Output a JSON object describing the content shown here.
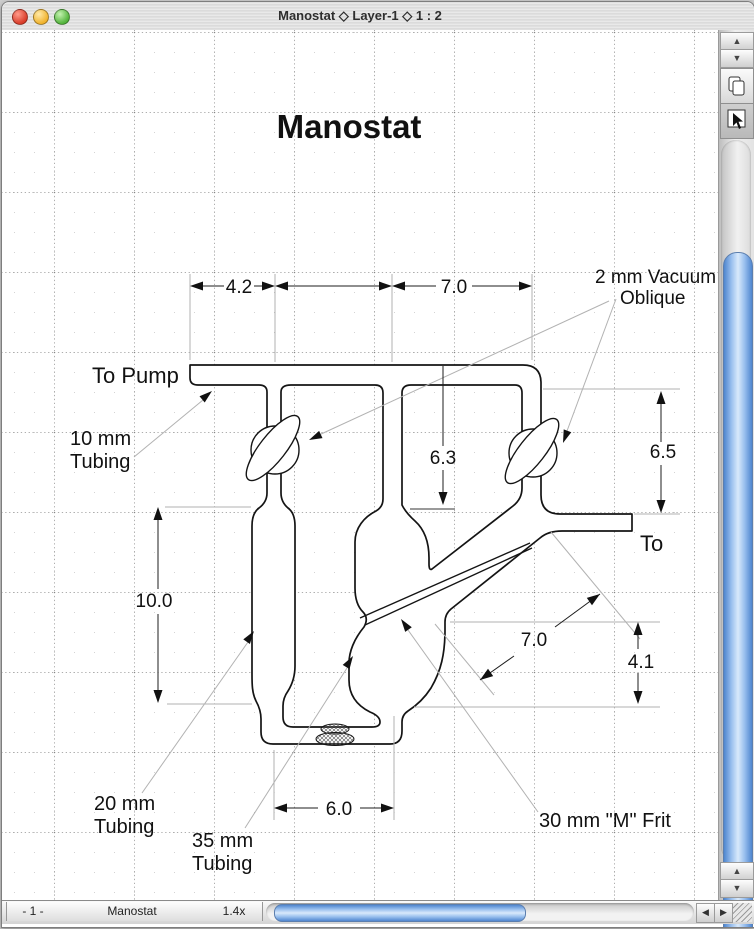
{
  "window": {
    "title": "Manostat ◇ Layer-1 ◇ 1 : 2"
  },
  "drawing": {
    "title": "Manostat",
    "labels": {
      "to_pump": "To Pump",
      "to": "To",
      "tubing10": [
        "10 mm",
        "Tubing"
      ],
      "tubing20": [
        "20 mm",
        "Tubing"
      ],
      "tubing35": [
        "35 mm",
        "Tubing"
      ],
      "frit": "30 mm \"M\" Frit",
      "oblique": [
        "2 mm Vacuum",
        "Oblique"
      ]
    },
    "dims": {
      "top_left": "4.2",
      "top_right": "7.0",
      "inner_depth": "6.3",
      "right_height": "6.5",
      "left_height": "10.0",
      "bottom_width": "6.0",
      "diagonal": "7.0",
      "outlet_height": "4.1"
    }
  },
  "statusbar": {
    "page": "- 1 -",
    "tab": "Manostat",
    "zoom": "1.4x"
  },
  "colors": {
    "scrollbar_blue": "#6ea3e8",
    "close": "#d93d2a",
    "minimize": "#f0b32e",
    "maximize": "#53b43c"
  }
}
